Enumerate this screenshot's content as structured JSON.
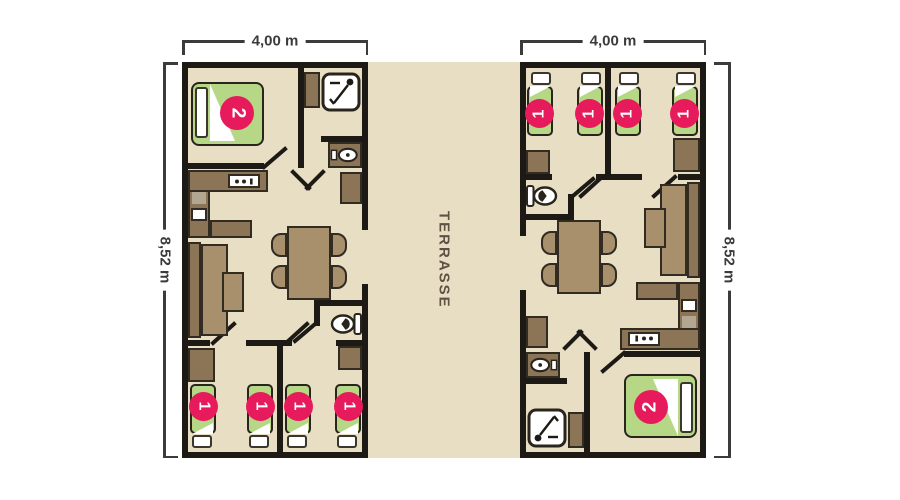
{
  "plan": {
    "terrace_label": "TERRASSE",
    "dim_width_left": "4,00 m",
    "dim_width_right": "4,00 m",
    "dim_height_left": "8,52 m",
    "dim_height_right": "8,52 m"
  },
  "units": [
    {
      "id": "left",
      "double_bed_capacity": "2",
      "single_bed_capacities": [
        "1",
        "1",
        "1",
        "1"
      ]
    },
    {
      "id": "right",
      "double_bed_capacity": "2",
      "single_bed_capacities": [
        "1",
        "1",
        "1",
        "1"
      ]
    }
  ],
  "colors": {
    "floor": "#e8dec4",
    "wall": "#1d1a15",
    "furniture_dark": "#8c7557",
    "furniture_light": "#a8906c",
    "bed_green": "#b5d786",
    "badge_pink": "#e71a5c",
    "dimension_text": "#3b3b3b",
    "terrace_text": "#5f5244"
  }
}
